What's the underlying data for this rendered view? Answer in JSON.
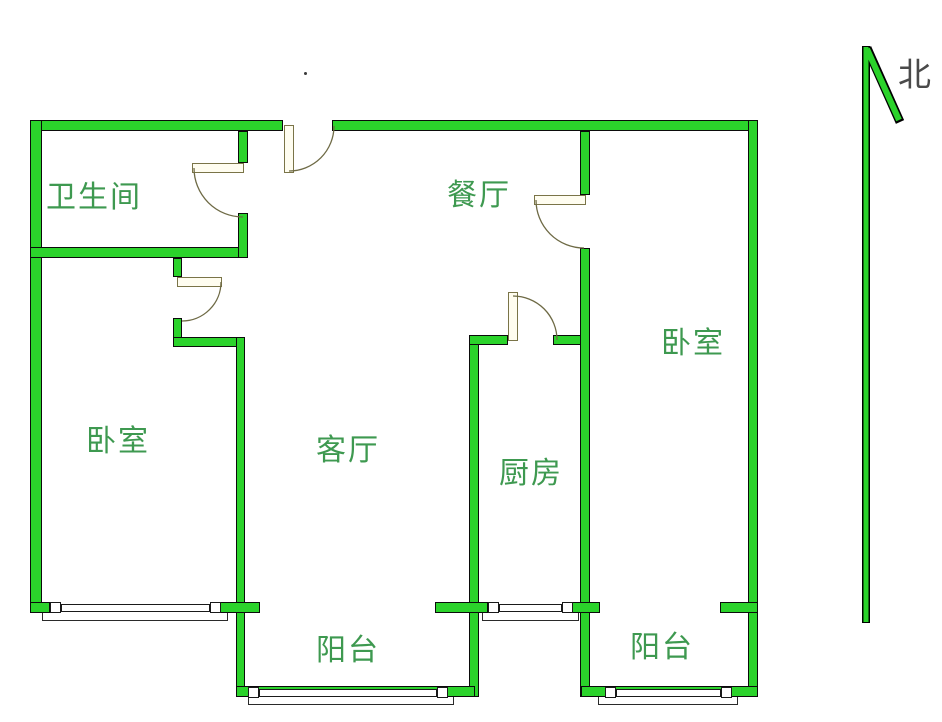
{
  "colors": {
    "wall_green": "#2bd32b",
    "label_green": "#3e9950",
    "door_line": "#6e6a45",
    "door_leaf_fill": "#fffdf0",
    "north_text": "#4a4a4a"
  },
  "labels": {
    "bathroom": "卫生间",
    "dining": "餐厅",
    "bedroom_right": "卧室",
    "bedroom_left": "卧室",
    "living": "客厅",
    "kitchen": "厨房",
    "balcony_middle": "阳台",
    "balcony_right": "阳台",
    "north": "北"
  }
}
